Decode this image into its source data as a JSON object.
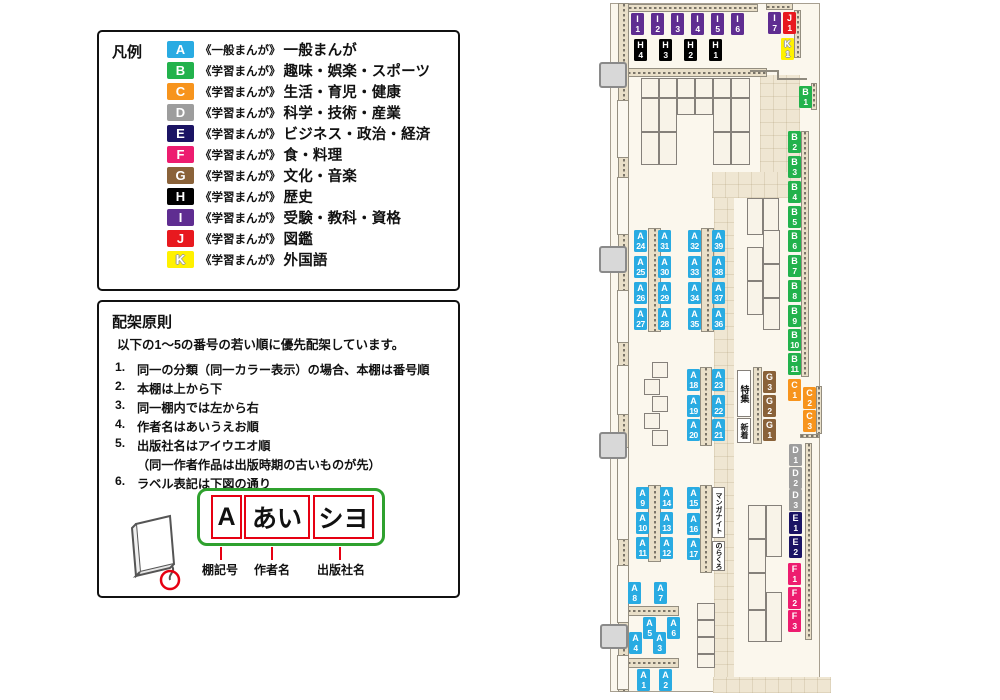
{
  "legend": {
    "title": "凡例",
    "items": [
      {
        "code": "A",
        "color": "#29ABE2",
        "series": "《一般まんが》",
        "label": "一般まんが"
      },
      {
        "code": "B",
        "color": "#22B24C",
        "series": "《学習まんが》",
        "label": "趣味・娯楽・スポーツ"
      },
      {
        "code": "C",
        "color": "#F7941D",
        "series": "《学習まんが》",
        "label": "生活・育児・健康"
      },
      {
        "code": "D",
        "color": "#9D9D9D",
        "series": "《学習まんが》",
        "label": "科学・技術・産業"
      },
      {
        "code": "E",
        "color": "#1B1464",
        "series": "《学習まんが》",
        "label": "ビジネス・政治・経済"
      },
      {
        "code": "F",
        "color": "#ED1C6F",
        "series": "《学習まんが》",
        "label": "食・料理"
      },
      {
        "code": "G",
        "color": "#8A6239",
        "series": "《学習まんが》",
        "label": "文化・音楽"
      },
      {
        "code": "H",
        "color": "#000000",
        "series": "《学習まんが》",
        "label": "歴史"
      },
      {
        "code": "I",
        "color": "#5F2D91",
        "series": "《学習まんが》",
        "label": "受験・教科・資格"
      },
      {
        "code": "J",
        "color": "#E8191F",
        "series": "《学習まんが》",
        "label": "図鑑"
      },
      {
        "code": "K",
        "color": "#FFF100",
        "series": "《学習まんが》",
        "label": "外国語",
        "light_text_outline": true
      }
    ]
  },
  "principles": {
    "title": "配架原則",
    "intro": "以下の1～5の番号の若い順に優先配架しています。",
    "rules": [
      {
        "num": "1.",
        "text": "同一の分類（同一カラー表示）の場合、本棚は番号順"
      },
      {
        "num": "2.",
        "text": "本棚は上から下"
      },
      {
        "num": "3.",
        "text": "同一棚内では左から右"
      },
      {
        "num": "4.",
        "text": "作者名はあいうえお順"
      },
      {
        "num": "5.",
        "text": "出版社名はアイウエオ順",
        "sub": "（同一作者作品は出版時期の古いものが先）"
      },
      {
        "num": "6.",
        "text": "ラベル表記は下図の通り"
      }
    ],
    "label_example": {
      "boxes": [
        "A",
        "あい",
        "シヨ"
      ],
      "captions": [
        "棚記号",
        "作者名",
        "出版社名"
      ]
    }
  },
  "map": {
    "shelf_labels": [
      {
        "id": "I1",
        "x": 631,
        "y": 13
      },
      {
        "id": "I2",
        "x": 651,
        "y": 13
      },
      {
        "id": "I3",
        "x": 671,
        "y": 13
      },
      {
        "id": "I4",
        "x": 691,
        "y": 13
      },
      {
        "id": "I5",
        "x": 711,
        "y": 13
      },
      {
        "id": "I6",
        "x": 731,
        "y": 13
      },
      {
        "id": "I7",
        "x": 768,
        "y": 12
      },
      {
        "id": "J1",
        "x": 783,
        "y": 12
      },
      {
        "id": "K1",
        "x": 781,
        "y": 38
      },
      {
        "id": "H4",
        "x": 634,
        "y": 39
      },
      {
        "id": "H3",
        "x": 659,
        "y": 39
      },
      {
        "id": "H2",
        "x": 684,
        "y": 39
      },
      {
        "id": "H1",
        "x": 709,
        "y": 39
      },
      {
        "id": "B1",
        "x": 799,
        "y": 86
      },
      {
        "id": "B2",
        "x": 788,
        "y": 131
      },
      {
        "id": "B3",
        "x": 788,
        "y": 156
      },
      {
        "id": "B4",
        "x": 788,
        "y": 181
      },
      {
        "id": "B5",
        "x": 788,
        "y": 206
      },
      {
        "id": "B6",
        "x": 788,
        "y": 230
      },
      {
        "id": "B7",
        "x": 788,
        "y": 255
      },
      {
        "id": "B8",
        "x": 788,
        "y": 280
      },
      {
        "id": "B9",
        "x": 788,
        "y": 305
      },
      {
        "id": "B10",
        "x": 788,
        "y": 329
      },
      {
        "id": "B11",
        "x": 788,
        "y": 353
      },
      {
        "id": "C1",
        "x": 788,
        "y": 379
      },
      {
        "id": "C2",
        "x": 803,
        "y": 387
      },
      {
        "id": "C3",
        "x": 803,
        "y": 410
      },
      {
        "id": "D1",
        "x": 789,
        "y": 444
      },
      {
        "id": "D2",
        "x": 789,
        "y": 467
      },
      {
        "id": "D3",
        "x": 789,
        "y": 489
      },
      {
        "id": "E1",
        "x": 789,
        "y": 512
      },
      {
        "id": "E2",
        "x": 789,
        "y": 536
      },
      {
        "id": "F1",
        "x": 788,
        "y": 563
      },
      {
        "id": "F2",
        "x": 788,
        "y": 587
      },
      {
        "id": "F3",
        "x": 788,
        "y": 610
      },
      {
        "id": "G3",
        "x": 763,
        "y": 371
      },
      {
        "id": "G2",
        "x": 763,
        "y": 395
      },
      {
        "id": "G1",
        "x": 763,
        "y": 419
      },
      {
        "id": "A24",
        "x": 634,
        "y": 230
      },
      {
        "id": "A31",
        "x": 658,
        "y": 230
      },
      {
        "id": "A25",
        "x": 634,
        "y": 256
      },
      {
        "id": "A30",
        "x": 658,
        "y": 256
      },
      {
        "id": "A26",
        "x": 634,
        "y": 282
      },
      {
        "id": "A29",
        "x": 658,
        "y": 282
      },
      {
        "id": "A27",
        "x": 634,
        "y": 308
      },
      {
        "id": "A28",
        "x": 658,
        "y": 308
      },
      {
        "id": "A32",
        "x": 688,
        "y": 230
      },
      {
        "id": "A39",
        "x": 712,
        "y": 230
      },
      {
        "id": "A33",
        "x": 688,
        "y": 256
      },
      {
        "id": "A38",
        "x": 712,
        "y": 256
      },
      {
        "id": "A34",
        "x": 688,
        "y": 282
      },
      {
        "id": "A37",
        "x": 712,
        "y": 282
      },
      {
        "id": "A35",
        "x": 688,
        "y": 308
      },
      {
        "id": "A36",
        "x": 712,
        "y": 308
      },
      {
        "id": "A18",
        "x": 687,
        "y": 369
      },
      {
        "id": "A23",
        "x": 712,
        "y": 369
      },
      {
        "id": "A19",
        "x": 687,
        "y": 395
      },
      {
        "id": "A22",
        "x": 712,
        "y": 395
      },
      {
        "id": "A20",
        "x": 687,
        "y": 419
      },
      {
        "id": "A21",
        "x": 712,
        "y": 419
      },
      {
        "id": "A9",
        "x": 636,
        "y": 487
      },
      {
        "id": "A14",
        "x": 660,
        "y": 487
      },
      {
        "id": "A10",
        "x": 636,
        "y": 512
      },
      {
        "id": "A13",
        "x": 660,
        "y": 512
      },
      {
        "id": "A11",
        "x": 636,
        "y": 537
      },
      {
        "id": "A12",
        "x": 660,
        "y": 537
      },
      {
        "id": "A15",
        "x": 687,
        "y": 487
      },
      {
        "id": "A16",
        "x": 687,
        "y": 513
      },
      {
        "id": "A17",
        "x": 687,
        "y": 538
      },
      {
        "id": "A8",
        "x": 628,
        "y": 582
      },
      {
        "id": "A7",
        "x": 654,
        "y": 582
      },
      {
        "id": "A5",
        "x": 643,
        "y": 617
      },
      {
        "id": "A6",
        "x": 667,
        "y": 617
      },
      {
        "id": "A4",
        "x": 629,
        "y": 632
      },
      {
        "id": "A3",
        "x": 653,
        "y": 632
      },
      {
        "id": "A1",
        "x": 637,
        "y": 669
      },
      {
        "id": "A2",
        "x": 659,
        "y": 669
      }
    ],
    "text_boxes": [
      {
        "text": "特集",
        "x": 737,
        "y": 370,
        "w": 14,
        "h": 47,
        "fs": 9
      },
      {
        "text": "新着",
        "x": 737,
        "y": 418,
        "w": 14,
        "h": 25,
        "fs": 8
      },
      {
        "text": "マンガナイト",
        "x": 712,
        "y": 487,
        "w": 13,
        "h": 51,
        "fs": 7
      },
      {
        "text": "のらくろ",
        "x": 712,
        "y": 541,
        "w": 13,
        "h": 30,
        "fs": 7
      }
    ]
  }
}
